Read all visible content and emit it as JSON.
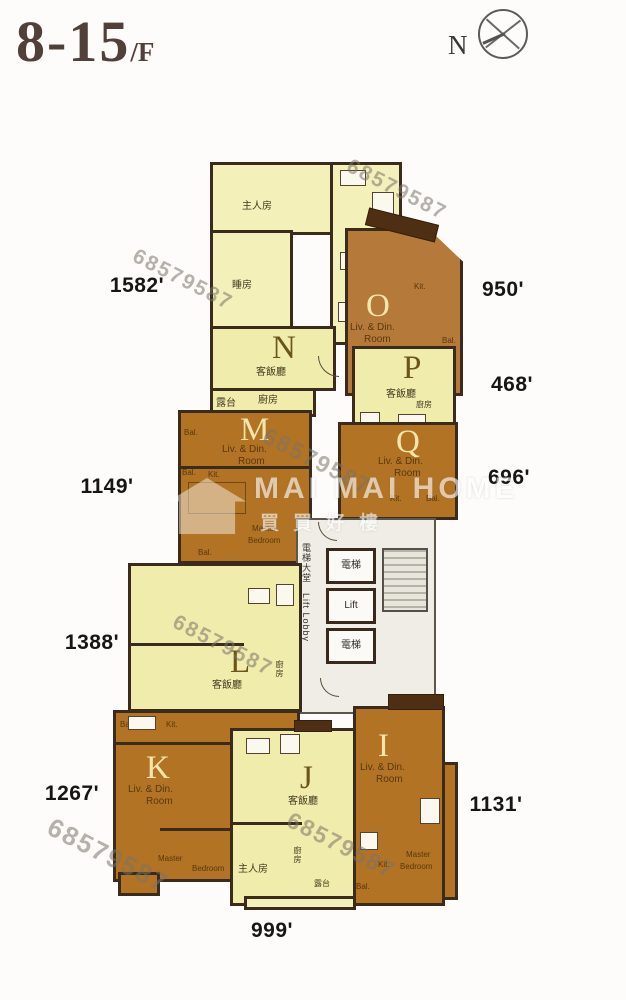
{
  "header": {
    "title_main": "8-15",
    "title_suffix": "/F",
    "compass_label": "N"
  },
  "areas": {
    "n": "1582'",
    "o": "950'",
    "p": "468'",
    "q": "696'",
    "m": "1149'",
    "l": "1388'",
    "k": "1267'",
    "i": "1131'",
    "j": "999'"
  },
  "units": {
    "n": {
      "letter": "N",
      "living": "客飯廳",
      "master": "主人房",
      "bedroom": "睡房",
      "balcony": "露台",
      "kitchen": "廚房"
    },
    "o": {
      "letter": "O",
      "living_1": "Liv. & Din.",
      "living_2": "Room",
      "kitchen": "Kit.",
      "balcony": "Bal."
    },
    "p": {
      "letter": "P",
      "living": "客飯廳",
      "kitchen": "廚房"
    },
    "m": {
      "letter": "M",
      "living_1": "Liv. & Din.",
      "living_2": "Room",
      "bal_1": "Bal.",
      "bal_2": "Bal.",
      "bal_3": "Bal.",
      "kitchen": "Kit.",
      "master_1": "Master",
      "master_2": "Bedroom"
    },
    "q": {
      "letter": "Q",
      "living_1": "Liv. & Din.",
      "living_2": "Room",
      "kitchen": "Kit.",
      "balcony": "Bal."
    },
    "l": {
      "letter": "L",
      "living": "客飯廳",
      "kitchen": "廚房"
    },
    "k": {
      "letter": "K",
      "living_1": "Liv. & Din.",
      "living_2": "Room",
      "balcony": "Bal.",
      "kitchen": "Kit.",
      "master_1": "Master",
      "master_2": "Bedroom"
    },
    "j": {
      "letter": "J",
      "living": "客飯廳",
      "master": "主人房",
      "kitchen": "廚房",
      "balcony": "露台"
    },
    "i": {
      "letter": "I",
      "living_1": "Liv. & Din.",
      "living_2": "Room",
      "kitchen": "Kit.",
      "master_1": "Master",
      "master_2": "Bedroom",
      "balcony": "Bal."
    }
  },
  "core": {
    "lobby_cn": "電梯大堂",
    "lobby_en": "Lift Lobby",
    "lift_top": "電梯",
    "lift_mid": "Lift",
    "lift_bottom": "電梯"
  },
  "watermark": {
    "phone": "68579587",
    "brand": "MAI MAI HOME",
    "brand_cn": "買買好樓"
  }
}
